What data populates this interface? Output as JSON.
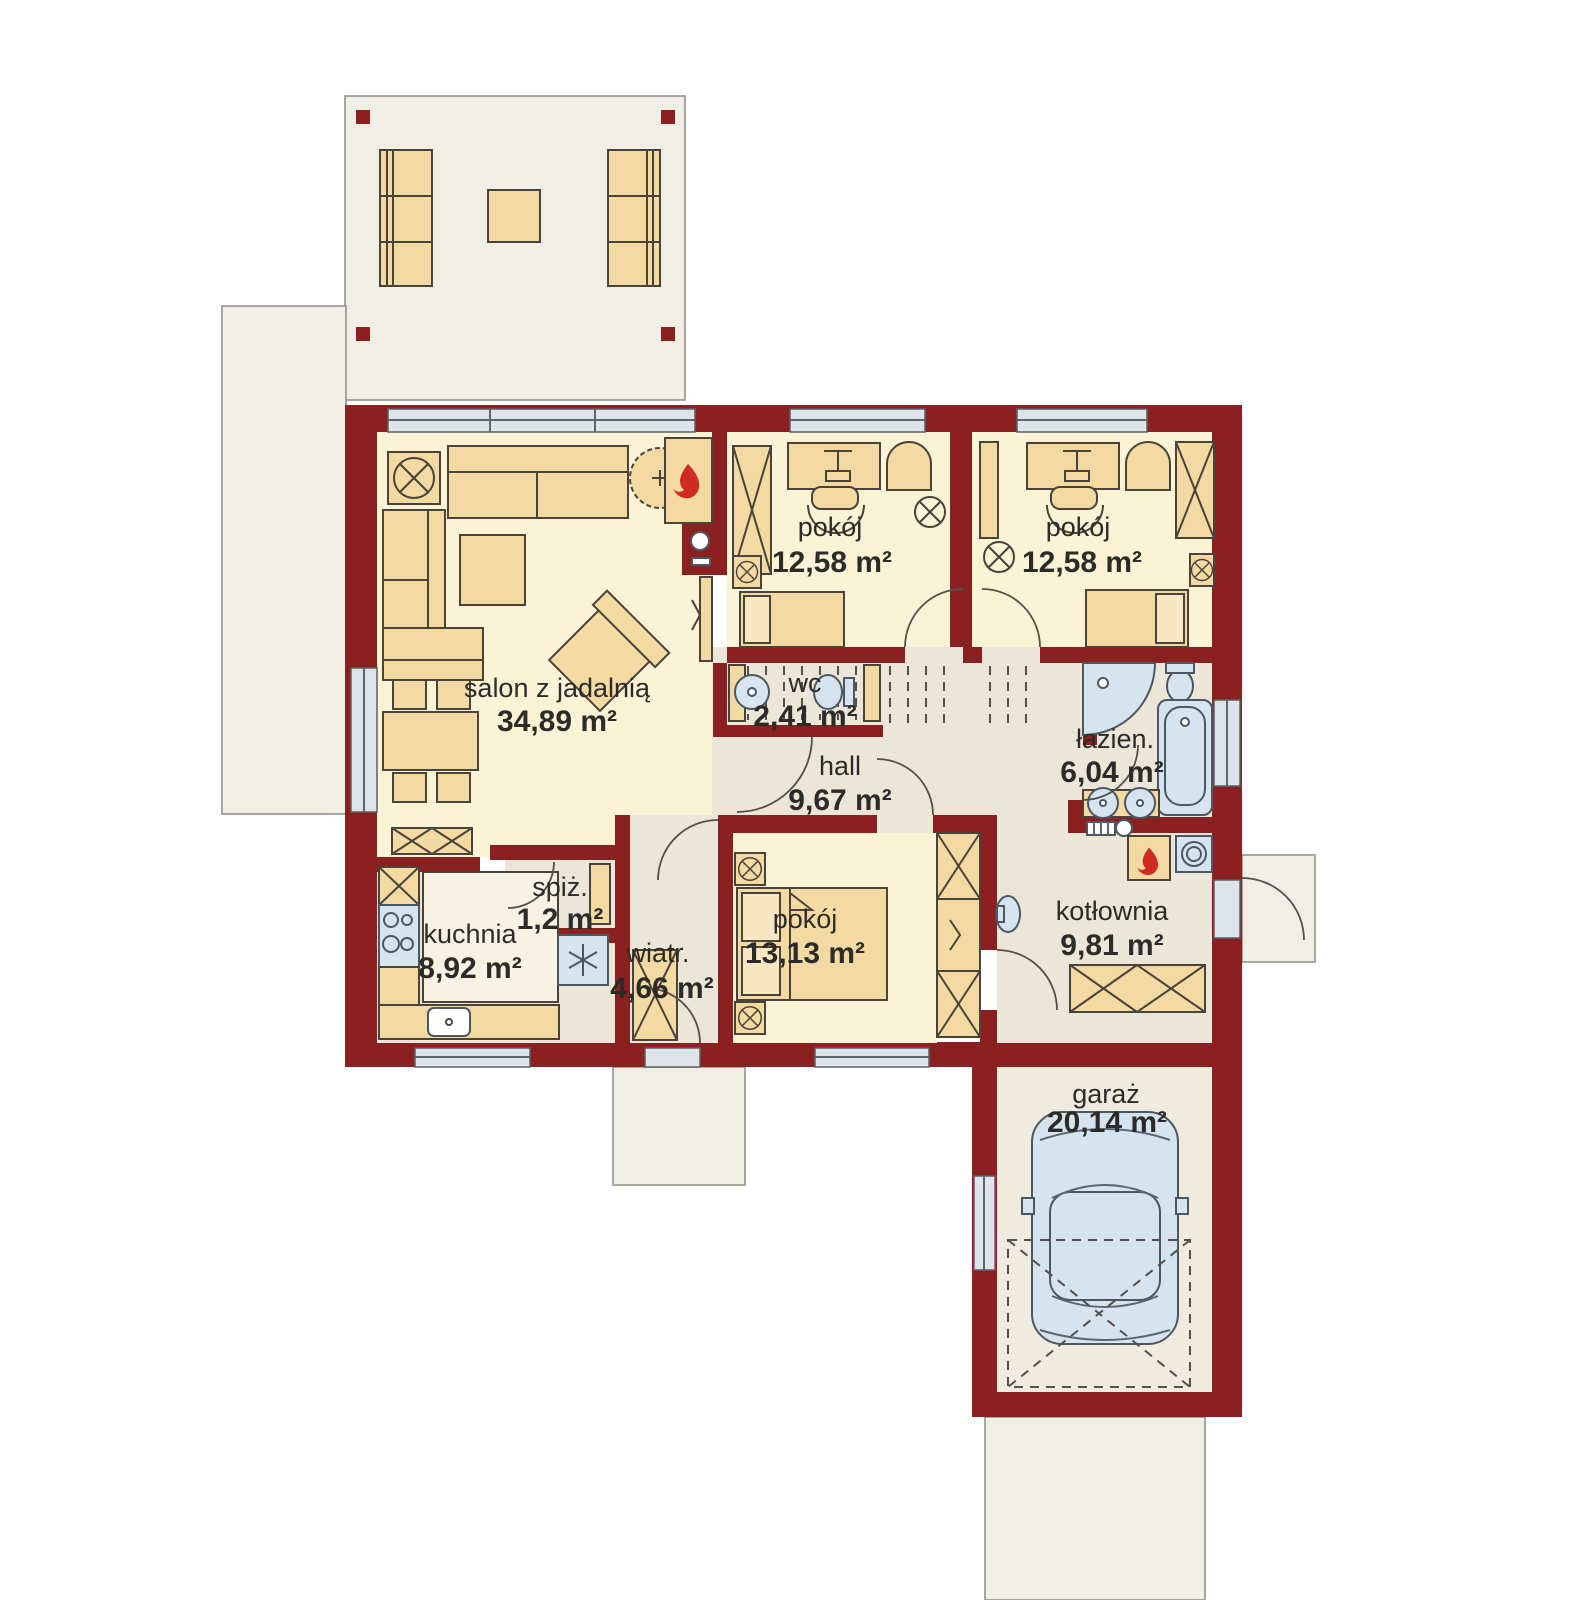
{
  "plan": {
    "type": "house-floor-plan",
    "rooms": [
      {
        "id": "salon",
        "name": "salon z jadalnią",
        "area": "34,89 m²"
      },
      {
        "id": "pokoj-1",
        "name": "pokój",
        "area": "12,58 m²"
      },
      {
        "id": "pokoj-2",
        "name": "pokój",
        "area": "12,58 m²"
      },
      {
        "id": "wc",
        "name": "wc",
        "area": "2,41 m²"
      },
      {
        "id": "hall",
        "name": "hall",
        "area": "9,67 m²"
      },
      {
        "id": "lazienka",
        "name": "łazien.",
        "area": "6,04 m²"
      },
      {
        "id": "spizarnia",
        "name": "spiż.",
        "area": "1,2 m²"
      },
      {
        "id": "kuchnia",
        "name": "kuchnia",
        "area": "8,92 m²"
      },
      {
        "id": "wiatrolap",
        "name": "wiatr.",
        "area": "4,66 m²"
      },
      {
        "id": "pokoj-3",
        "name": "pokój",
        "area": "13,13 m²"
      },
      {
        "id": "kotlownia",
        "name": "kotłownia",
        "area": "9,81 m²"
      },
      {
        "id": "garaz",
        "name": "garaż",
        "area": "20,14 m²"
      }
    ],
    "colors": {
      "wall": "#8b2020",
      "room_floor": "#faf3d6",
      "service_floor": "#ebe6d8",
      "garage_floor": "#f0ebdf",
      "outdoor": "#f1efe5",
      "furniture": "#f3d9a2",
      "fixture": "#d6e4f0",
      "window": "#dee5ea",
      "flame": "#cf2b20",
      "text": "#2d2b28"
    },
    "icons": {
      "fireplace-icon": "flame",
      "boiler-flame-icon": "flame",
      "fridge-snowflake-icon": "✳",
      "lamp-icon": "⊗",
      "car-icon": "car top view"
    }
  }
}
